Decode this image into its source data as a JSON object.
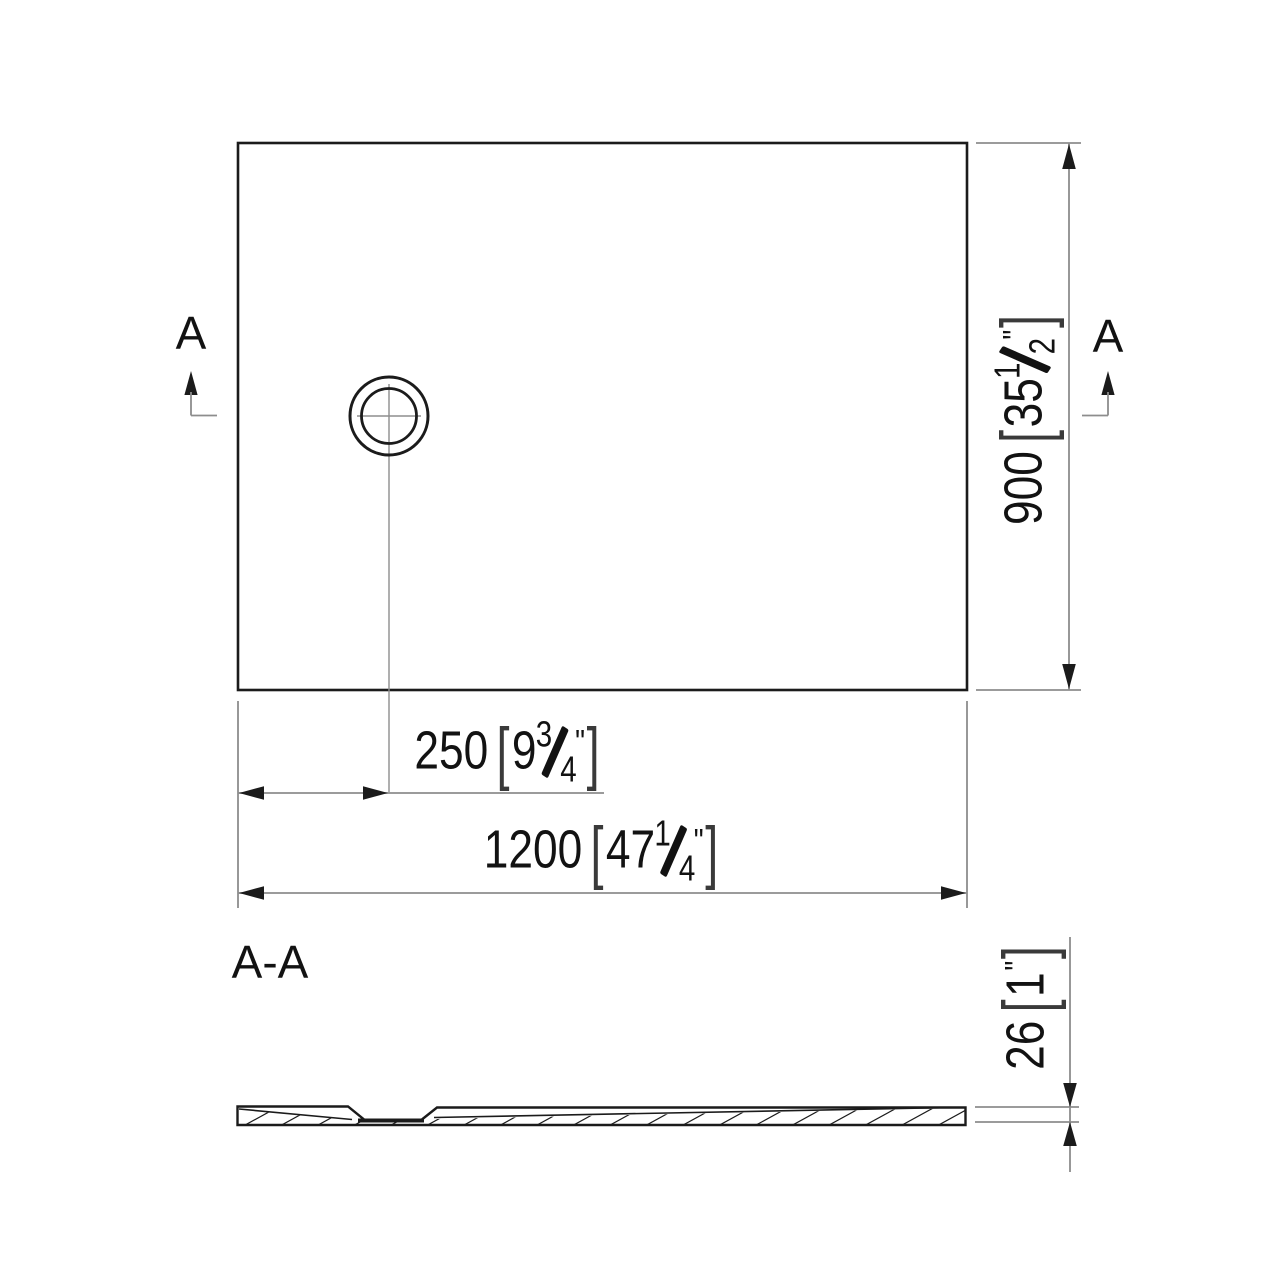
{
  "colors": {
    "object_line": "#1b1b1b",
    "dimension_line": "#8d8d8d",
    "text": "#121212",
    "background": "#ffffff"
  },
  "labels": {
    "cut_marker": "A",
    "section_title": "A-A"
  },
  "dimensions": {
    "length": {
      "metric": "1200",
      "bracket_open": "[",
      "imperial_whole": "47",
      "fraction_numerator": "1",
      "fraction_denominator": "4",
      "unit_mark": "\"",
      "bracket_close": "]"
    },
    "depth": {
      "metric": "900",
      "bracket_open": "[",
      "imperial_whole": "35",
      "fraction_numerator": "1",
      "fraction_denominator": "2",
      "unit_mark": "\"",
      "bracket_close": "]"
    },
    "drain_offset": {
      "metric": "250",
      "bracket_open": "[",
      "imperial_whole": "9",
      "fraction_numerator": "3",
      "fraction_denominator": "4",
      "unit_mark": "\"",
      "bracket_close": "]"
    },
    "thickness": {
      "metric": "26",
      "bracket_open": "[",
      "imperial_whole": "1",
      "unit_mark": "\"",
      "bracket_close": "]"
    }
  }
}
